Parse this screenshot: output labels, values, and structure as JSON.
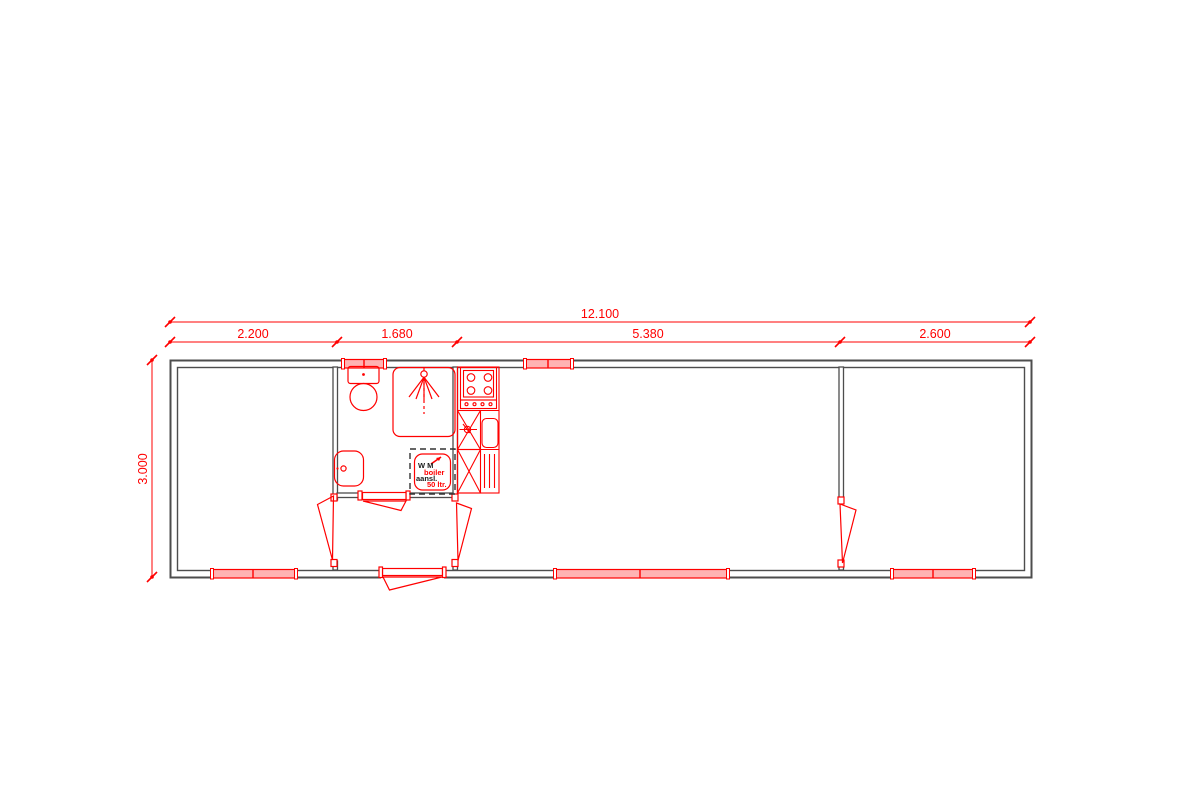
{
  "plan": {
    "dimensions": {
      "overall": "12.100",
      "segments": [
        "2.200",
        "1.680",
        "5.380",
        "2.600"
      ],
      "height": "3.000"
    },
    "labels": {
      "wm_line1": "W M",
      "wm_line2": "aansl.",
      "boiler_line1": "boiler",
      "boiler_line2": "50 ltr."
    },
    "colors": {
      "line_red": "#ff0000",
      "wall_gray": "#4d4d4d",
      "window_fill": "#ffb3b3"
    }
  }
}
